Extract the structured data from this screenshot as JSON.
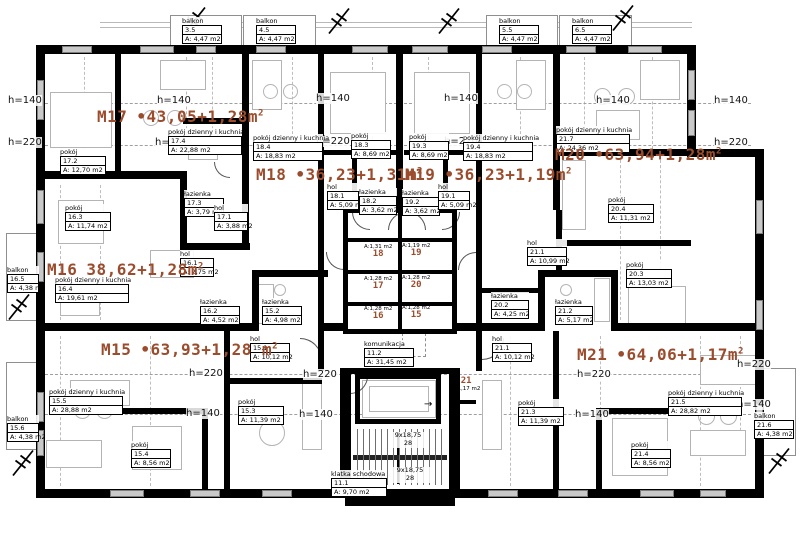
{
  "apartments": [
    {
      "id": "M17",
      "area": "•43,05+1,28m",
      "sup": "2"
    },
    {
      "id": "M18",
      "area": "•36,23+1,31m",
      "sup": "2"
    },
    {
      "id": "M19",
      "area": "•36,23+1,19m",
      "sup": "2"
    },
    {
      "id": "M20",
      "area": "•63,94+1,28m",
      "sup": "2"
    },
    {
      "id": "M16",
      "area": "38,62+1,28m",
      "sup": "2"
    },
    {
      "id": "M15",
      "area": "•63,93+1,28 m",
      "sup": "2"
    },
    {
      "id": "M21",
      "area": "•64,06+1,17m",
      "sup": "2"
    }
  ],
  "rooms": {
    "r17_1": {
      "name": "hol",
      "num": "17.1",
      "area": "A: 3,88 m2"
    },
    "r17_2": {
      "name": "pokój",
      "num": "17.2",
      "area": "A: 12,70 m2"
    },
    "r17_3": {
      "name": "łazienka",
      "num": "17.3",
      "area": "A: 3,79 m2"
    },
    "r17_4": {
      "name": "pokój dzienny i kuchnia",
      "num": "17.4",
      "area": "A: 22,88 m2"
    },
    "r16_1": {
      "name": "hol",
      "num": "16.1",
      "area": "A: 2,75 m2"
    },
    "r16_2": {
      "name": "łazienka",
      "num": "16.2",
      "area": "A: 4,52 m2"
    },
    "r16_3": {
      "name": "pokój",
      "num": "16.3",
      "area": "A: 11,74 m2"
    },
    "r16_4": {
      "name": "pokój dzienny i kuchnia",
      "num": "16.4",
      "area": "A: 19,61 m2"
    },
    "b16_5": {
      "name": "balkon",
      "num": "16.5",
      "area": "A: 4,38 m2"
    },
    "r15_1": {
      "name": "hol",
      "num": "15.1",
      "area": "A: 10,12 m2"
    },
    "r15_2": {
      "name": "łazienka",
      "num": "15.2",
      "area": "A: 4,98 m2"
    },
    "r15_3": {
      "name": "pokój",
      "num": "15.3",
      "area": "A: 11,39 m2"
    },
    "r15_4": {
      "name": "pokój",
      "num": "15.4",
      "area": "A: 8,56 m2"
    },
    "r15_5": {
      "name": "pokój dzienny i kuchnia",
      "num": "15.5",
      "area": "A: 28,88 m2"
    },
    "b15_6": {
      "name": "balkon",
      "num": "15.6",
      "area": "A: 4,38 m2"
    },
    "r18_1": {
      "name": "hol",
      "num": "18.1",
      "area": "A: 5,09 m2"
    },
    "r18_2": {
      "name": "łazienka",
      "num": "18.2",
      "area": "A: 3,62 m2"
    },
    "r18_3": {
      "name": "pokój",
      "num": "18.3",
      "area": "A: 8,69 m2"
    },
    "r18_4": {
      "name": "pokój dzienny i kuchnia",
      "num": "18.4",
      "area": "A: 18,83 m2"
    },
    "r19_1": {
      "name": "hol",
      "num": "19.1",
      "area": "A: 5,09 m2"
    },
    "r19_2": {
      "name": "łazienka",
      "num": "19.2",
      "area": "A: 3,62 m2"
    },
    "r19_3": {
      "name": "pokój",
      "num": "19.3",
      "area": "A: 8,69 m2"
    },
    "r19_4": {
      "name": "pokój dzienny i kuchnia",
      "num": "19.4",
      "area": "A: 18,83 m2"
    },
    "r20_1": {
      "name": "hol",
      "num": "21.1",
      "area": "A: 10,99 m2"
    },
    "r20_2": {
      "name": "łazienka",
      "num": "20.2",
      "area": "A: 4,25 m2"
    },
    "r20_3": {
      "name": "pokój",
      "num": "20.3",
      "area": "A: 13,03 m2"
    },
    "r20_4": {
      "name": "pokój",
      "num": "20.4",
      "area": "A: 11,31 m2"
    },
    "r20_5": {
      "name": "pokój dzienny i kuchnia",
      "num": "21.7",
      "area": "A: 24,36 m2"
    },
    "r21_1": {
      "name": "hol",
      "num": "21.1",
      "area": "A: 10,12 m2"
    },
    "r21_2": {
      "name": "łazienka",
      "num": "21.2",
      "area": "A: 5,17 m2"
    },
    "r21_3": {
      "name": "pokój",
      "num": "21.3",
      "area": "A: 11,39 m2"
    },
    "r21_4": {
      "name": "pokój",
      "num": "21.4",
      "area": "A: 8,56 m2"
    },
    "r21_5": {
      "name": "pokój dzienny i kuchnia",
      "num": "21.5",
      "area": "A: 28,82 m2"
    },
    "b21_6": {
      "name": "balkon",
      "num": "21.6",
      "area": "A: 4,38 m2"
    },
    "b3_5": {
      "name": "balkon",
      "num": "3.5",
      "area": "A: 4,47 m2"
    },
    "b4_5": {
      "name": "balkon",
      "num": "4.5",
      "area": "A: 4,47 m2"
    },
    "b5_5": {
      "name": "balkon",
      "num": "5.5",
      "area": "A: 4,47 m2"
    },
    "b6_5": {
      "name": "balkon",
      "num": "6.5",
      "area": "A: 4,47 m2"
    },
    "k11_2": {
      "name": "komunikacja",
      "num": "11.2",
      "area": "A: 31,45 m2"
    },
    "k11_1": {
      "name": "klatka schodowa",
      "num": "11.1",
      "area": "A: 9,70 m2"
    }
  },
  "storages": {
    "s15": {
      "num": "15",
      "area": "A:1,28 m2"
    },
    "s16": {
      "num": "16",
      "area": "A:1,28 m2"
    },
    "s17": {
      "num": "17",
      "area": "A:1,28 m2"
    },
    "s18": {
      "num": "18",
      "area": "A:1,31 m2"
    },
    "s19": {
      "num": "19",
      "area": "A:1,19 m2"
    },
    "s20": {
      "num": "20",
      "area": "A:1,28 m2"
    },
    "s21": {
      "num": "21",
      "area": "A:1,17 m2"
    }
  },
  "heights": {
    "h140": "h=140",
    "h220": "h=220"
  },
  "stairs": {
    "flight": "9x18,75",
    "steps": "28"
  },
  "misc": {
    "arrow": "→"
  },
  "colors": {
    "apartment_label": "#9b4c2d",
    "wall": "#000000"
  }
}
